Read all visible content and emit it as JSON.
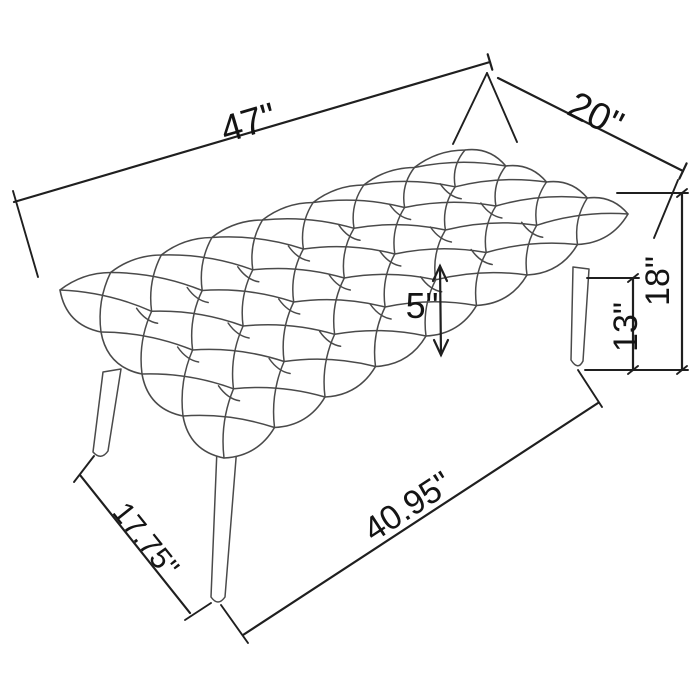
{
  "diagram": {
    "title": "Tufted bench dimension drawing",
    "background_color": "#ffffff",
    "drawing_line_color": "#4a4a4a",
    "dimension_line_color": "#1f1f1f",
    "labels": {
      "width": "47\"",
      "depth": "20\"",
      "height": "18\"",
      "seat_clearance": "13\"",
      "cushion_thickness": "5\"",
      "leg_span_depth": "17.75\"",
      "leg_span_width": "40.95\""
    }
  }
}
